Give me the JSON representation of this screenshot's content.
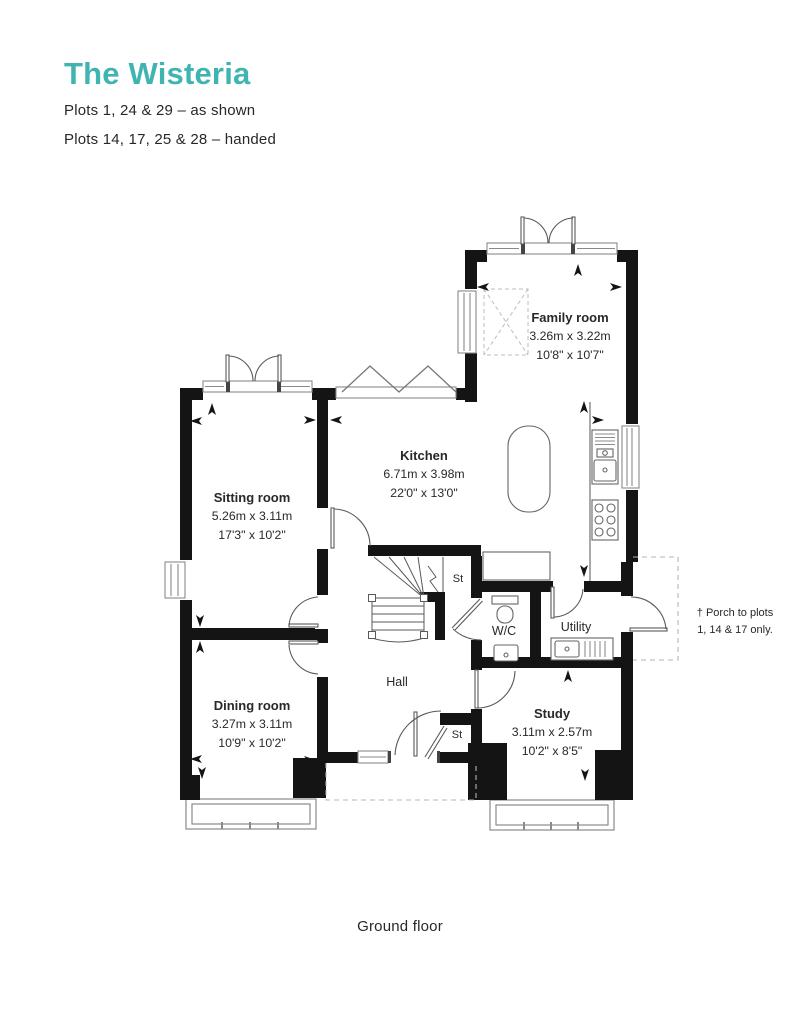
{
  "header": {
    "title": "The Wisteria",
    "subtitle_line1": "Plots 1, 24 & 29 – as shown",
    "subtitle_line2": "Plots 14, 17, 25 & 28 – handed"
  },
  "colors": {
    "accent_teal": "#3fb4b0",
    "text": "#26282a",
    "wall": "#141414"
  },
  "floorplan": {
    "caption": "Ground floor",
    "rooms": [
      {
        "name": "Family room",
        "metric": "3.26m x 3.22m",
        "imperial": "10'8\" x 10'7\""
      },
      {
        "name": "Kitchen",
        "metric": "6.71m x 3.98m",
        "imperial": "22'0\" x 13'0\""
      },
      {
        "name": "Sitting room",
        "metric": "5.26m x 3.11m",
        "imperial": "17'3\" x 10'2\""
      },
      {
        "name": "Dining room",
        "metric": "3.27m x 3.11m",
        "imperial": "10'9\" x 10'2\""
      },
      {
        "name": "Study",
        "metric": "3.11m x 2.57m",
        "imperial": "10'2\" x 8'5\""
      }
    ],
    "small_rooms": {
      "hall": "Hall",
      "wc": "W/C",
      "utility": "Utility",
      "stair_store": "St",
      "entrance_store": "St"
    },
    "note": {
      "line1": "† Porch to plots",
      "line2": "1, 14 & 17 only."
    }
  }
}
